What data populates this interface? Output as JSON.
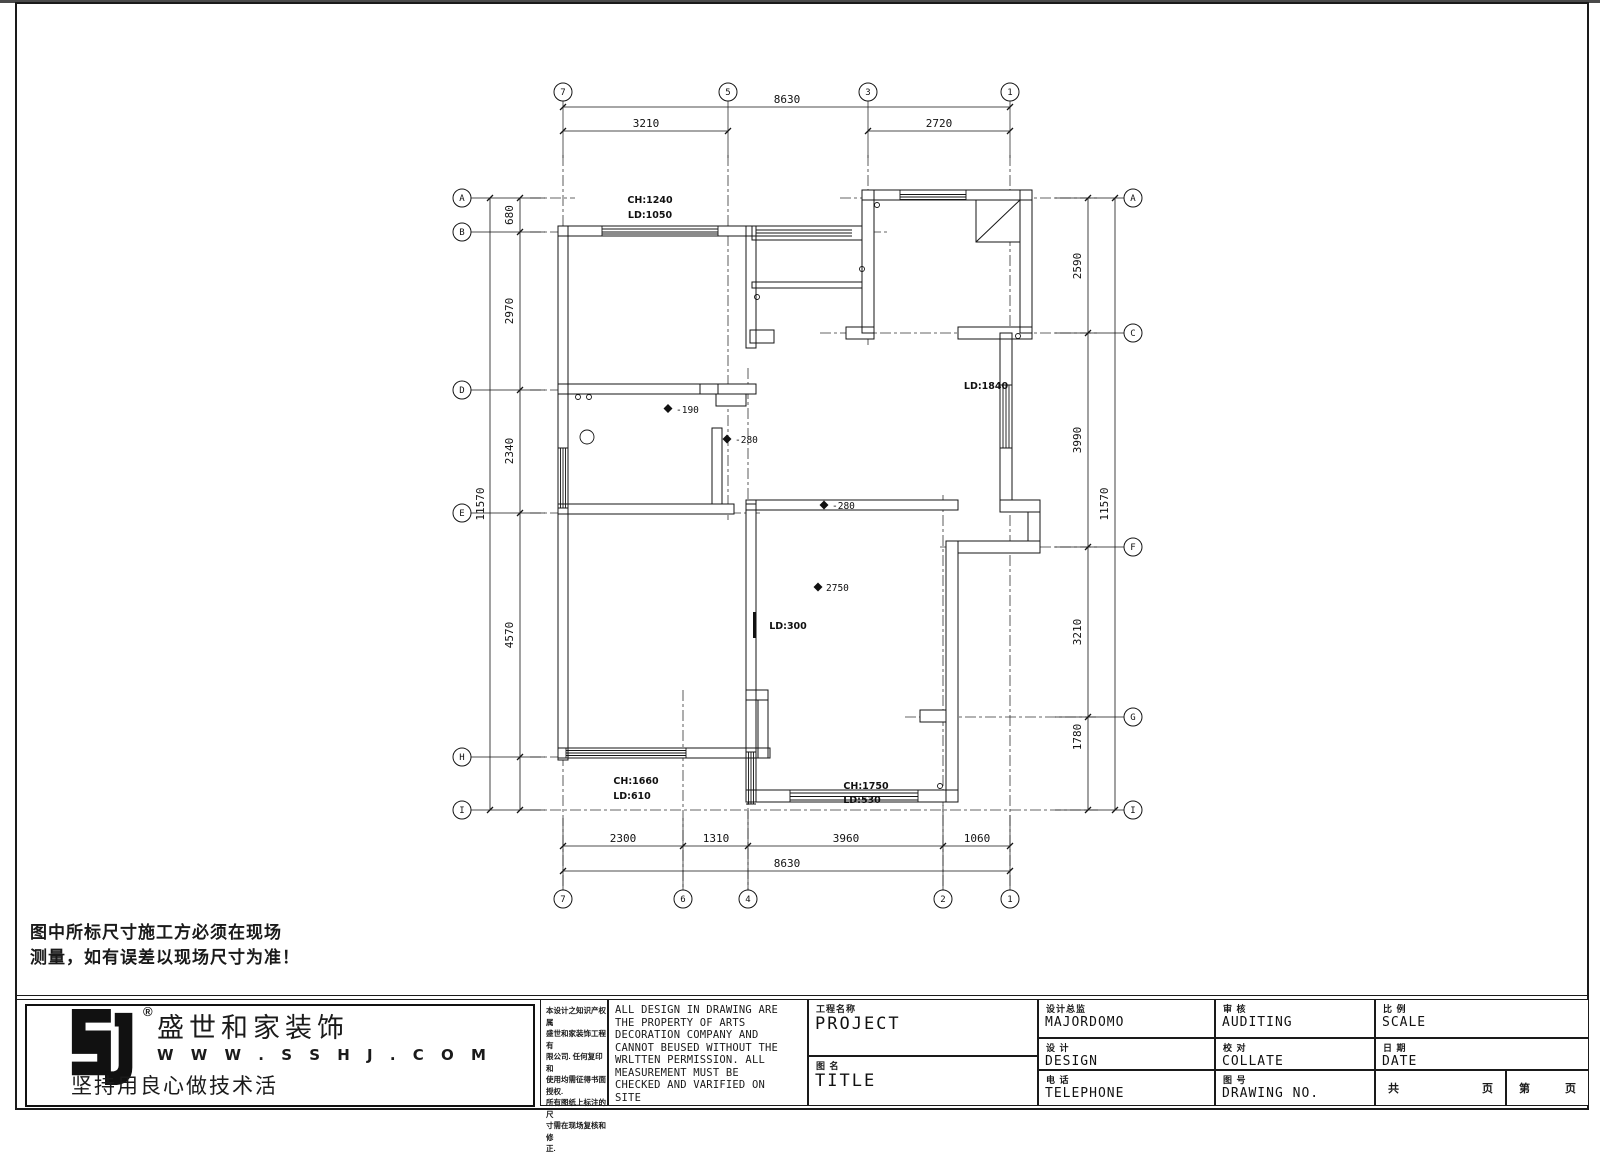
{
  "page": {
    "warning_line1": "图中所标尺寸施工方必须在现场",
    "warning_line2": "测量，如有误差以现场尺寸为准！"
  },
  "logo": {
    "reg": "®",
    "company_cn": "盛世和家装饰",
    "website": "W W W . S S H J . C O M",
    "slogan": "坚持用良心做技术活"
  },
  "titleblock": {
    "cn_notice": [
      "本设计之知识产权属",
      "盛世和家装饰工程有",
      "限公司. 任何复印和",
      "使用均需征得书面授权.",
      "所有图纸上标注的尺",
      "寸需在现场复核和修",
      "正."
    ],
    "en_notice": "ALL DESIGN IN DRAWING ARE\nTHE PROPERTY OF ARTS\nDECORATION COMPANY AND\nCANNOT BEUSED WITHOUT THE\nWRLTTEN PERMISSION. ALL\nMEASUREMENT MUST BE\nCHECKED AND VARIFIED ON\nSITE",
    "cells": {
      "project": {
        "cn": "工程名称",
        "en": "PROJECT"
      },
      "title": {
        "cn": "图  名",
        "en": "TITLE"
      },
      "majordomo": {
        "cn": "设计总监",
        "en": "MAJORDOMO"
      },
      "design": {
        "cn": "设  计",
        "en": "DESIGN"
      },
      "telephone": {
        "cn": "电  话",
        "en": "TELEPHONE"
      },
      "auditing": {
        "cn": "审  核",
        "en": "AUDITING"
      },
      "collate": {
        "cn": "校  对",
        "en": "COLLATE"
      },
      "drawing_no": {
        "cn": "图  号",
        "en": "DRAWING NO."
      },
      "scale": {
        "cn": "比  例",
        "en": "SCALE"
      },
      "date": {
        "cn": "日  期",
        "en": "DATE"
      },
      "pages": {
        "total": "共",
        "page1": "页",
        "no": "第",
        "page2": "页"
      }
    }
  },
  "plan": {
    "dims_top": {
      "overall": "8630",
      "left": "3210",
      "right": "2720"
    },
    "dims_bottom": {
      "segs": [
        "2300",
        "1310",
        "3960",
        "1060"
      ],
      "overall": "8630"
    },
    "dims_left": {
      "segs": [
        "680",
        "2970",
        "2340",
        "4570"
      ],
      "overall": "11570"
    },
    "dims_right": {
      "segs": [
        "2590",
        "3990",
        "3210",
        "1780"
      ],
      "overall": "11570"
    },
    "grid_top": [
      "7",
      "5",
      "3",
      "1"
    ],
    "grid_bottom": [
      "7",
      "6",
      "4",
      "2",
      "1"
    ],
    "grid_left": [
      "A",
      "B",
      "D",
      "E",
      "H",
      "I"
    ],
    "grid_right": [
      "A",
      "C",
      "F",
      "G",
      "I"
    ],
    "labels": {
      "win_top_ch": "CH:1240",
      "win_top_ld": "LD:1050",
      "win_right_ld": "LD:1840",
      "win_bl_ch": "CH:1660",
      "win_bl_ld": "LD:610",
      "win_bc_ch": "CH:1750",
      "win_bc_ld": "LD:530",
      "ld300": "LD:300",
      "lvl1": "-190",
      "lvl2": "-280",
      "lvl3": "-280",
      "lvl4": "2750"
    }
  }
}
